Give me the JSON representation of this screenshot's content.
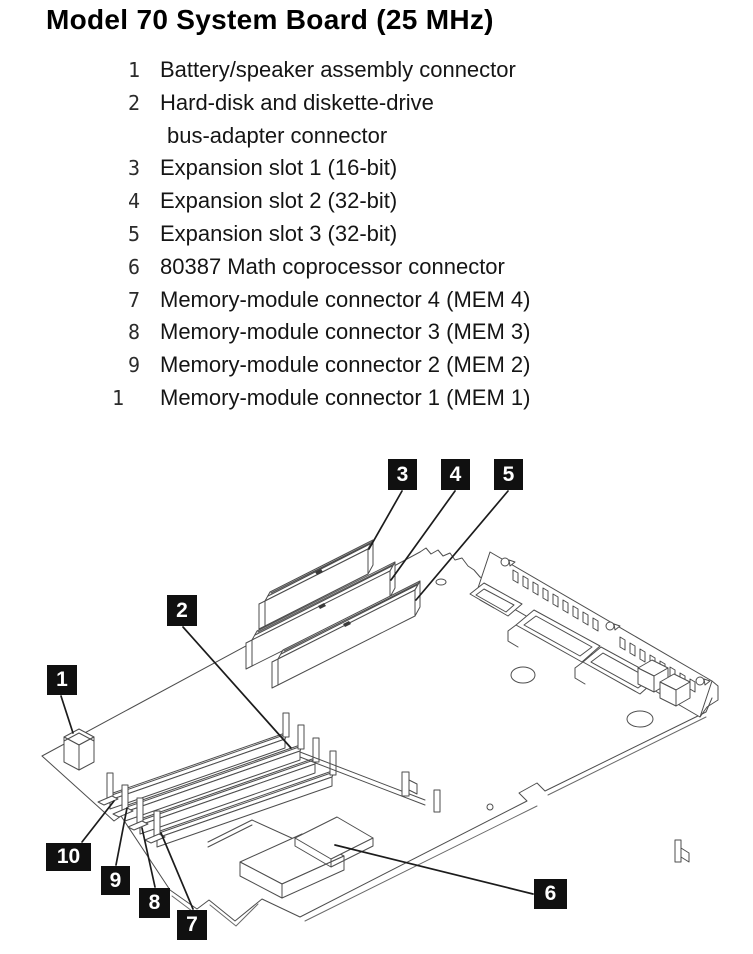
{
  "title": "Model 70 System Board (25 MHz)",
  "legend": {
    "items": [
      {
        "num": "1",
        "text": "Battery/speaker assembly connector"
      },
      {
        "num": "2",
        "text": "Hard-disk and diskette-drive"
      },
      {
        "num": "",
        "text": "bus-adapter connector"
      },
      {
        "num": "3",
        "text": "Expansion slot 1 (16-bit)"
      },
      {
        "num": "4",
        "text": "Expansion slot 2 (32-bit)"
      },
      {
        "num": "5",
        "text": "Expansion slot 3 (32-bit)"
      },
      {
        "num": "6",
        "text": "80387 Math coprocessor connector"
      },
      {
        "num": "7",
        "text": "Memory-module connector 4 (MEM 4)"
      },
      {
        "num": "8",
        "text": "Memory-module connector 3 (MEM 3)"
      },
      {
        "num": "9",
        "text": "Memory-module connector 2 (MEM 2)"
      },
      {
        "num": "1",
        "text": "Memory-module connector 1 (MEM 1)"
      }
    ]
  },
  "callouts": {
    "c1": {
      "label": "1"
    },
    "c2": {
      "label": "2"
    },
    "c3": {
      "label": "3"
    },
    "c4": {
      "label": "4"
    },
    "c5": {
      "label": "5"
    },
    "c6": {
      "label": "6"
    },
    "c7": {
      "label": "7"
    },
    "c8": {
      "label": "8"
    },
    "c9": {
      "label": "9"
    },
    "c10": {
      "label": "10"
    }
  },
  "colors": {
    "background": "#ffffff",
    "ink": "#111111",
    "line_art": "#4d4d4d",
    "callout_bg": "#101010",
    "callout_fg": "#ffffff"
  }
}
